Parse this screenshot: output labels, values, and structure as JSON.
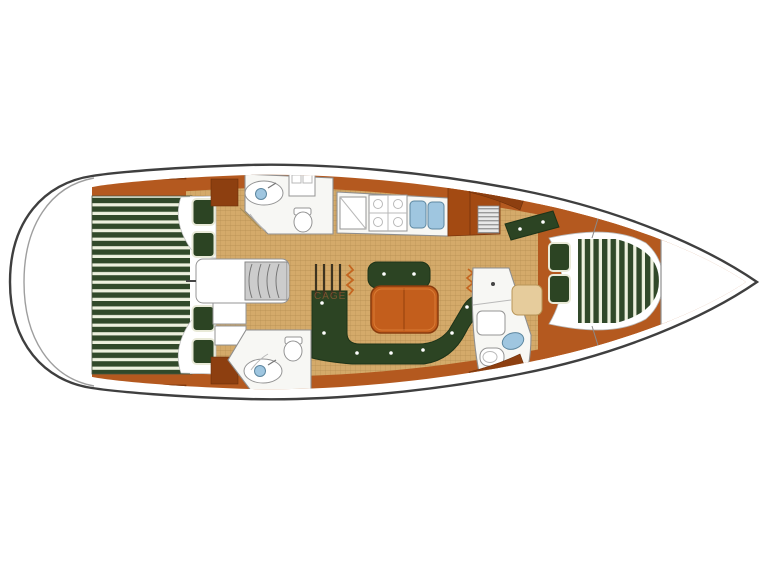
{
  "diagram": {
    "type": "sailboat-interior-floor-plan",
    "orientation": "bow-right, stern-left, top-down view",
    "watermark": "CAGE",
    "colors": {
      "hull_outline": "#3f3f3f",
      "hull_fill": "#ffffff",
      "interior_orange": "#b4591f",
      "locker_dark": "#8d3f10",
      "floor_tan": "#d4aa6a",
      "floor_line": "#b08a4e",
      "stripe_green": "#31492a",
      "stripe_cream": "#edf0de",
      "cushion_green": "#2c4423",
      "table_orange": "#c35e1c",
      "room_white": "#f7f7f4",
      "fixture_gray": "#8f8f8f",
      "sink_blue": "#9fc6e0",
      "steps_gray": "#cccccc",
      "seat_beige": "#e6cc9c"
    },
    "regions": [
      {
        "id": "stern-platform"
      },
      {
        "id": "aft-double-berth"
      },
      {
        "id": "aft-pillows"
      },
      {
        "id": "companionway-engine-box"
      },
      {
        "id": "port-head-bathroom"
      },
      {
        "id": "starboard-head-bathroom"
      },
      {
        "id": "galley-stove-and-sinks"
      },
      {
        "id": "salon-u-settee-and-table"
      },
      {
        "id": "mast-grab-rails"
      },
      {
        "id": "forward-head-bathroom"
      },
      {
        "id": "chart-seat"
      },
      {
        "id": "v-berth-forward-cabin"
      },
      {
        "id": "bow-anchor-locker"
      }
    ]
  }
}
